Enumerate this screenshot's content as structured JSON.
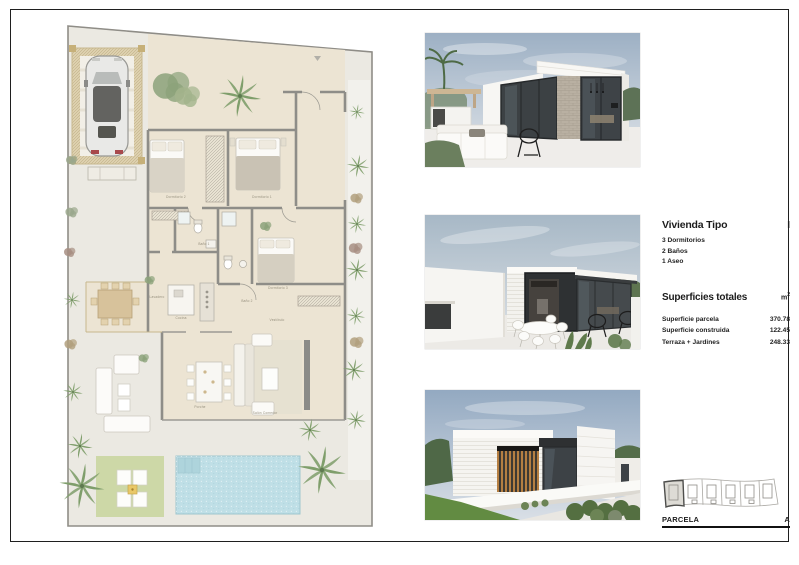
{
  "panel": {
    "title": "Vivienda Tipo",
    "type_mark": "I",
    "features": [
      "3 Dormitorios",
      "2 Baños",
      "1 Aseo"
    ],
    "surfaces_title": "Superficies totales",
    "unit": "m",
    "unit_exp": "2",
    "surfaces": [
      {
        "label": "Superficie parcela",
        "value": "370.78"
      },
      {
        "label": "Superficie construida",
        "value": "122.45"
      },
      {
        "label": "Terraza + Jardines",
        "value": "248.33"
      }
    ],
    "parcela_label": "PARCELA",
    "parcela_mark": "A"
  },
  "plan": {
    "labels": {
      "dormitorio2": "Dormitorio 2",
      "dormitorio1": "Dormitorio 1",
      "dormitorio3": "Dormitorio 3",
      "bano1": "Baño 1",
      "bano2": "Baño 2",
      "cocina": "Cocina",
      "vestibulo": "Vestíbulo",
      "lavadero": "Lavadero",
      "salon": "Salón Comedor",
      "porche": "Porche"
    },
    "colors": {
      "interior_floor": "#ece4d3",
      "terrace": "#ebe9e2",
      "walls": "#8e8d88",
      "pool": "#bfdfe6",
      "lawn": "#cdd8a7",
      "pergola": "#dbcda9"
    }
  }
}
